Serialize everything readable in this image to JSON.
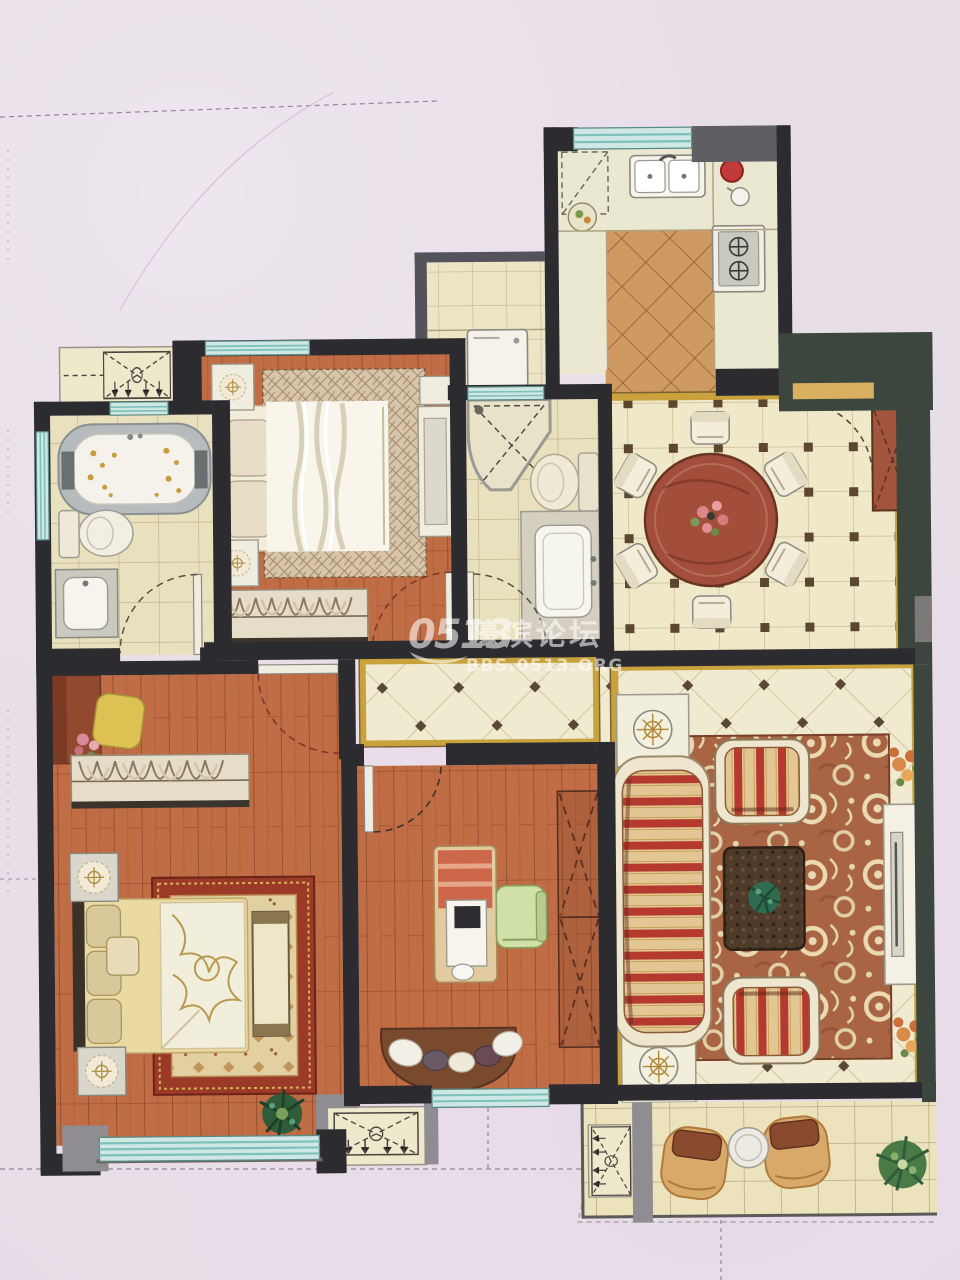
{
  "watermark": {
    "brand": "0513",
    "site_name": "濠滨论坛",
    "site_url": "BBS.0513.ORG"
  },
  "palette": {
    "paper": "#e8dee8",
    "wall_dark": "#2c2b2f",
    "wall_green": "#3d463e",
    "wall_gray": "#8f8d91",
    "wood_floor": "#c06c44",
    "tile_cream": "#ece4c2",
    "tile_warm": "#cf9a62",
    "window_glass": "#cfe8e4",
    "window_stripe": "#7ec0ba",
    "gold_trim": "#c9a23e",
    "rug_red": "#a86443",
    "stripe_red": "#b5392e",
    "stripe_cream": "#e2c795",
    "table_wood": "#a24e3a",
    "bedding_gold": "#ead9a0",
    "plant_green": "#2f6b4f",
    "accent_red": "#c33b38"
  }
}
